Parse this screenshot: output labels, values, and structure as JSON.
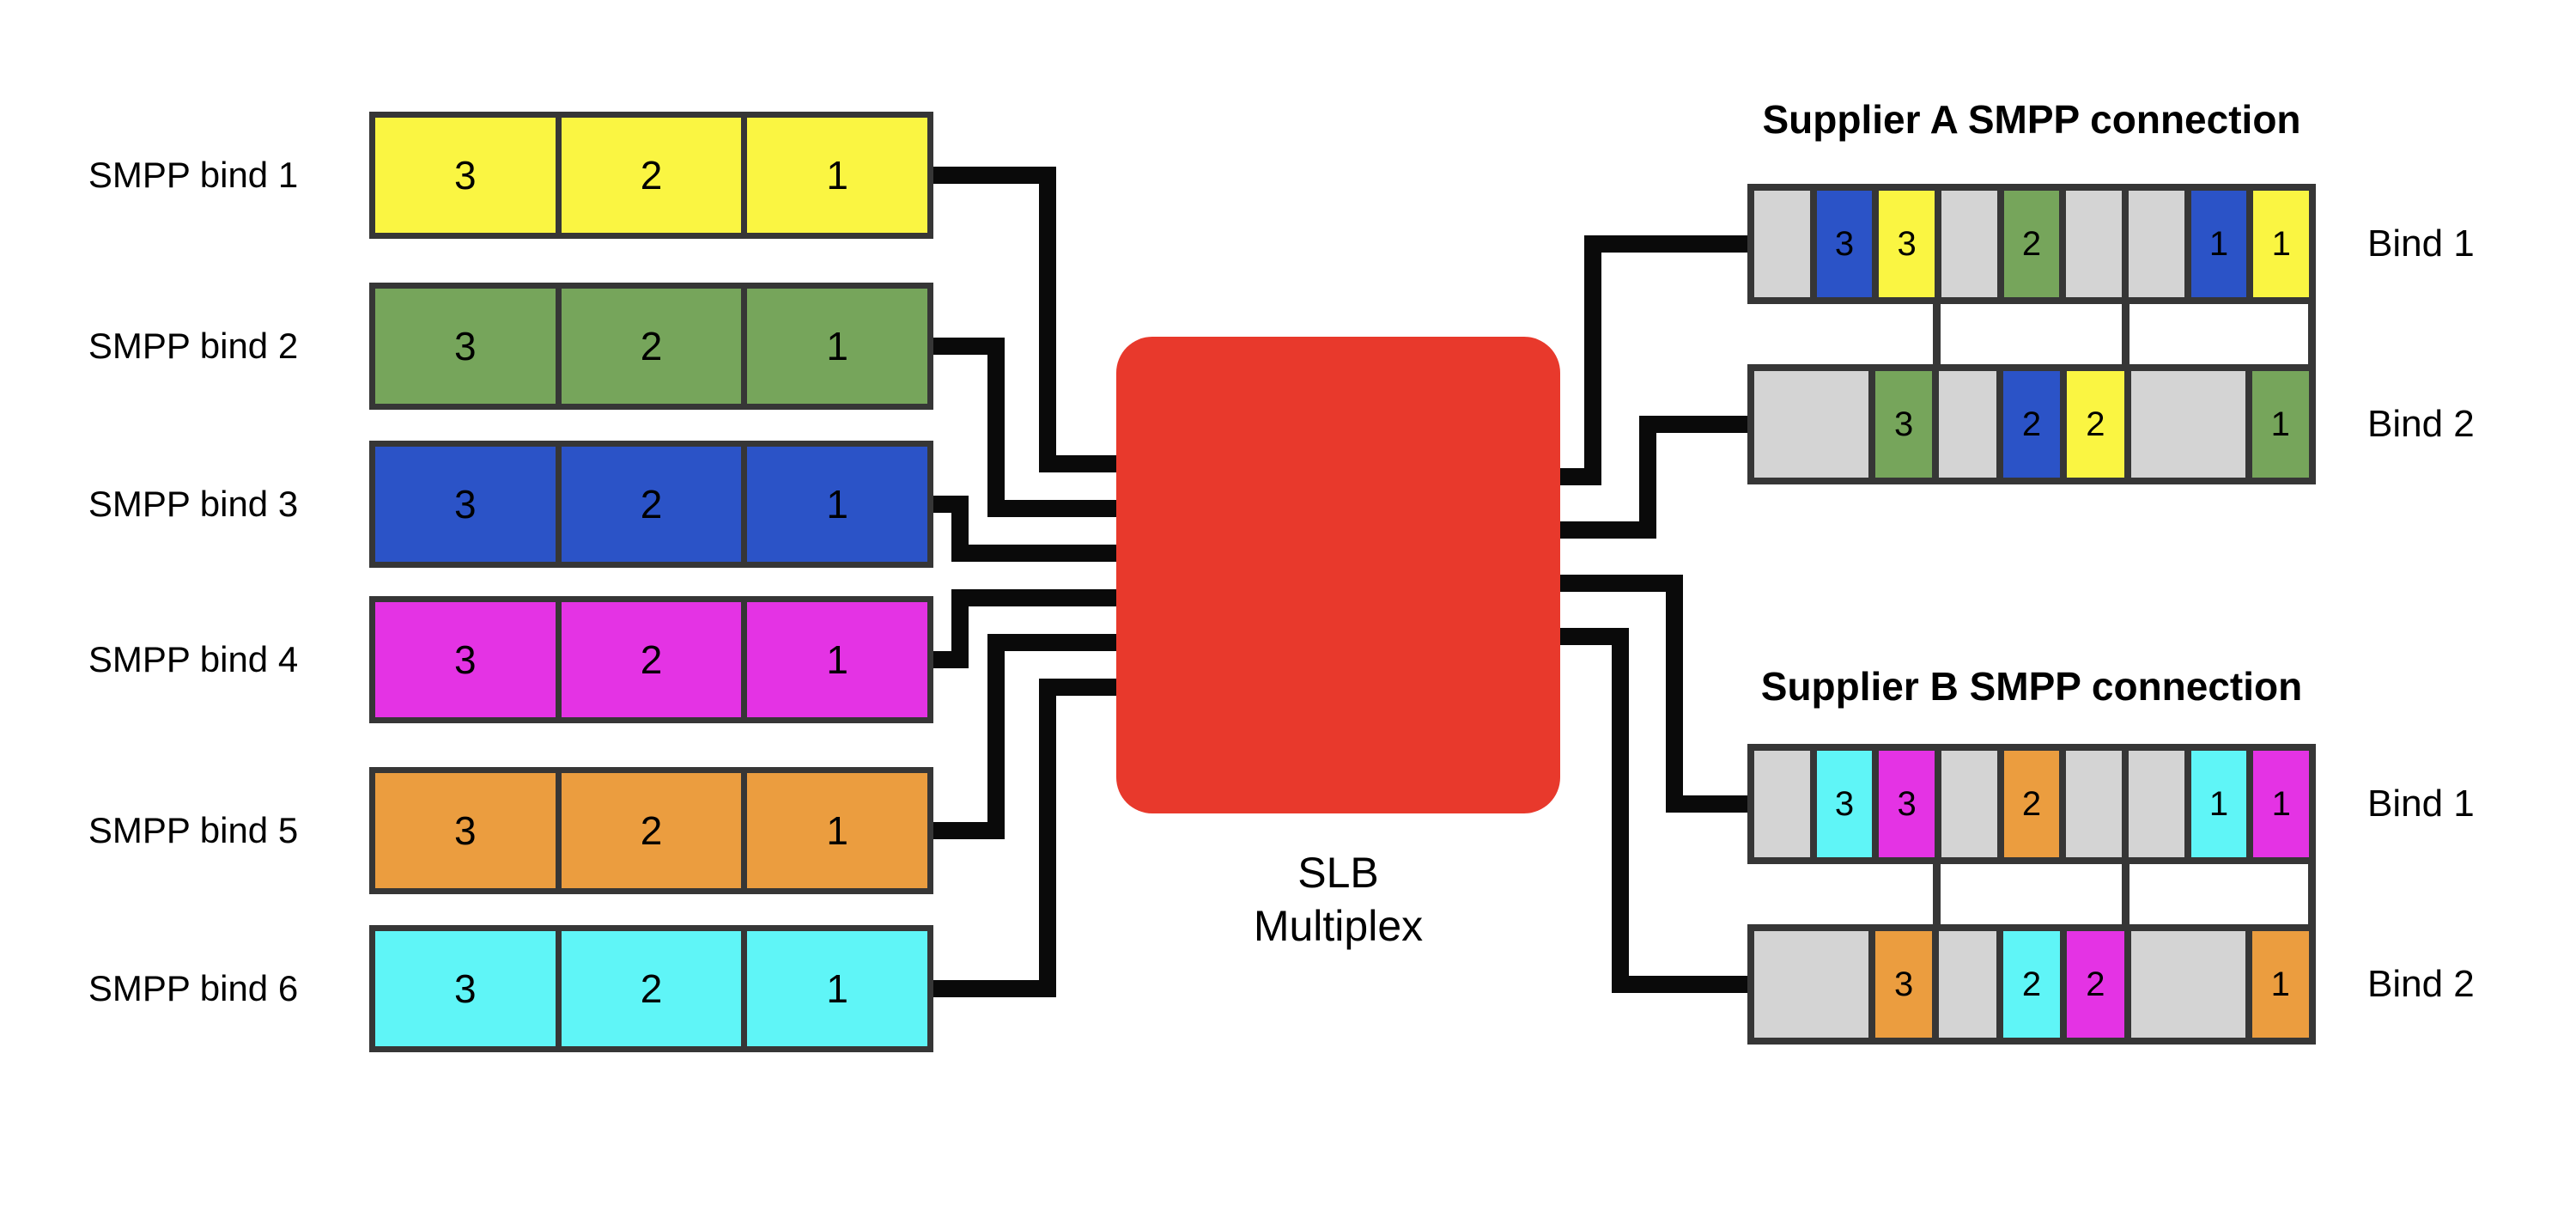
{
  "palette": {
    "yellow": "#faf542",
    "green": "#76a55b",
    "blue": "#2b53c7",
    "magenta": "#e433e4",
    "orange": "#eb9d3f",
    "cyan": "#5ff5f7",
    "gray": "#d4d4d4",
    "red": "#e8392c",
    "wire": "#0a0a0a",
    "border": "#363636"
  },
  "left_binds": [
    {
      "label": "SMPP bind 1",
      "color": "yellow",
      "cells": [
        "3",
        "2",
        "1"
      ]
    },
    {
      "label": "SMPP bind 2",
      "color": "green",
      "cells": [
        "3",
        "2",
        "1"
      ]
    },
    {
      "label": "SMPP bind 3",
      "color": "blue",
      "cells": [
        "3",
        "2",
        "1"
      ]
    },
    {
      "label": "SMPP bind 4",
      "color": "magenta",
      "cells": [
        "3",
        "2",
        "1"
      ]
    },
    {
      "label": "SMPP bind 5",
      "color": "orange",
      "cells": [
        "3",
        "2",
        "1"
      ]
    },
    {
      "label": "SMPP bind 6",
      "color": "cyan",
      "cells": [
        "3",
        "2",
        "1"
      ]
    }
  ],
  "multiplexer": {
    "line1": "SLB",
    "line2": "Multiplex"
  },
  "suppliers": [
    {
      "title": "Supplier A SMPP connection",
      "rows": [
        {
          "label": "Bind 1",
          "slots": [
            {
              "color": "gray",
              "text": "",
              "span": 1
            },
            {
              "color": "blue",
              "text": "3",
              "span": 1
            },
            {
              "color": "yellow",
              "text": "3",
              "span": 1
            },
            {
              "color": "gray",
              "text": "",
              "span": 1
            },
            {
              "color": "green",
              "text": "2",
              "span": 1
            },
            {
              "color": "gray",
              "text": "",
              "span": 1
            },
            {
              "color": "gray",
              "text": "",
              "span": 1
            },
            {
              "color": "blue",
              "text": "1",
              "span": 1
            },
            {
              "color": "yellow",
              "text": "1",
              "span": 1
            }
          ]
        },
        {
          "label": "Bind 2",
          "slots": [
            {
              "color": "gray",
              "text": "",
              "span": 2
            },
            {
              "color": "green",
              "text": "3",
              "span": 1
            },
            {
              "color": "gray",
              "text": "",
              "span": 1
            },
            {
              "color": "blue",
              "text": "2",
              "span": 1
            },
            {
              "color": "yellow",
              "text": "2",
              "span": 1
            },
            {
              "color": "gray",
              "text": "",
              "span": 2
            },
            {
              "color": "green",
              "text": "1",
              "span": 1
            }
          ]
        }
      ]
    },
    {
      "title": "Supplier B SMPP connection",
      "rows": [
        {
          "label": "Bind 1",
          "slots": [
            {
              "color": "gray",
              "text": "",
              "span": 1
            },
            {
              "color": "cyan",
              "text": "3",
              "span": 1
            },
            {
              "color": "magenta",
              "text": "3",
              "span": 1
            },
            {
              "color": "gray",
              "text": "",
              "span": 1
            },
            {
              "color": "orange",
              "text": "2",
              "span": 1
            },
            {
              "color": "gray",
              "text": "",
              "span": 1
            },
            {
              "color": "gray",
              "text": "",
              "span": 1
            },
            {
              "color": "cyan",
              "text": "1",
              "span": 1
            },
            {
              "color": "magenta",
              "text": "1",
              "span": 1
            }
          ]
        },
        {
          "label": "Bind 2",
          "slots": [
            {
              "color": "gray",
              "text": "",
              "span": 2
            },
            {
              "color": "orange",
              "text": "3",
              "span": 1
            },
            {
              "color": "gray",
              "text": "",
              "span": 1
            },
            {
              "color": "cyan",
              "text": "2",
              "span": 1
            },
            {
              "color": "magenta",
              "text": "2",
              "span": 1
            },
            {
              "color": "gray",
              "text": "",
              "span": 2
            },
            {
              "color": "orange",
              "text": "1",
              "span": 1
            }
          ]
        }
      ]
    }
  ]
}
